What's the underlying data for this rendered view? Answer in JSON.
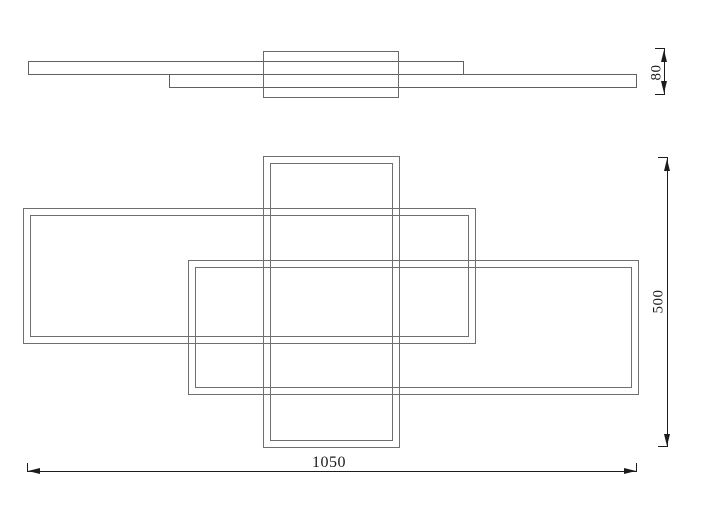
{
  "drawing": {
    "title": "ceiling-light-technical-drawing",
    "views": [
      {
        "id": "side-view",
        "name": "side profile view"
      },
      {
        "id": "front-view",
        "name": "front view"
      }
    ],
    "dimensions": {
      "width": {
        "label": "1050"
      },
      "height": {
        "label": "500"
      },
      "depth": {
        "label": "80"
      }
    },
    "colors": {
      "background": "#ffffff",
      "outline": "#6f6f6f",
      "dimension": "#1c1c1c"
    }
  }
}
